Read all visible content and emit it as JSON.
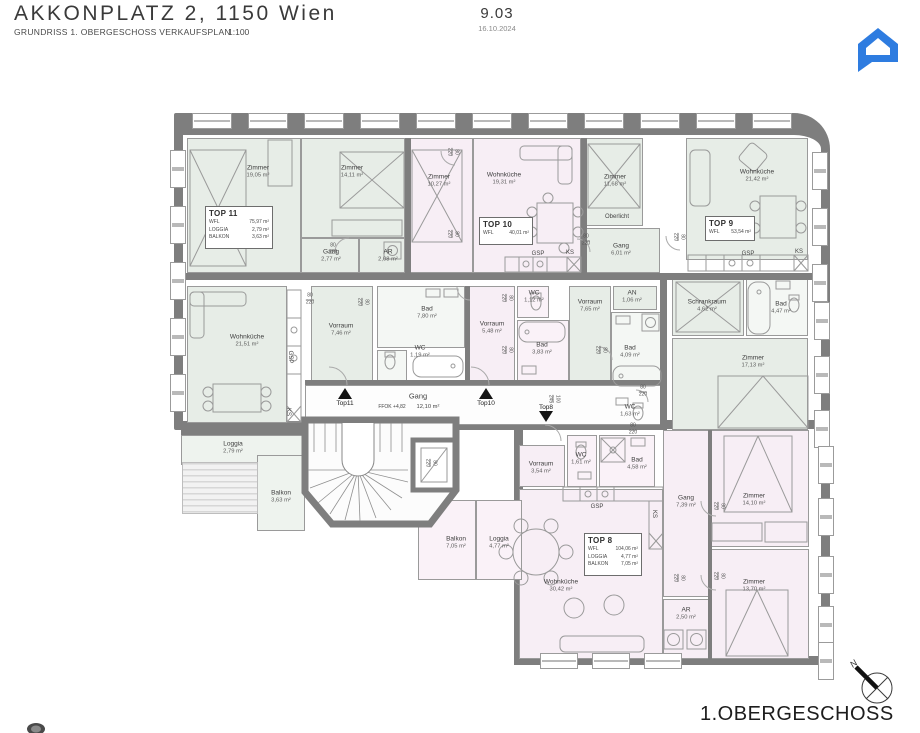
{
  "header": {
    "title": "AKKONPLATZ 2, 1150 Wien",
    "subtitle": "GRUNDRISS 1. OBERGESCHOSS VERKAUFSPLAN",
    "scale": "1:100",
    "plan_number": "9.03",
    "date": "16.10.2024"
  },
  "footer": {
    "floor_label": "1.OBERGESCHOSS",
    "north_label": "N"
  },
  "colors": {
    "accent_blue": "#2e7ce0",
    "wall_gray": "#7e7e7e",
    "mint": "#e7ede7",
    "pink": "#f7eef5",
    "mint_light": "#eef3ee",
    "pink_light": "#faf2f8",
    "white": "#fdfdfd",
    "white_tint": "#f4f7f4"
  },
  "tops": [
    {
      "id": "TOP 11",
      "x": 205,
      "y": 206,
      "w": 68,
      "h": 43,
      "rows": [
        [
          "WFL",
          "75,97 m²"
        ],
        [
          "LOGGIA",
          "2,79 m²"
        ],
        [
          "BALKON",
          "3,63 m²"
        ]
      ]
    },
    {
      "id": "TOP 10",
      "x": 479,
      "y": 217,
      "w": 54,
      "h": 28,
      "rows": [
        [
          "WFL",
          "40,01 m²"
        ]
      ]
    },
    {
      "id": "TOP 9",
      "x": 705,
      "y": 216,
      "w": 50,
      "h": 25,
      "rows": [
        [
          "WFL",
          "53,54 m²"
        ]
      ]
    },
    {
      "id": "TOP 8",
      "x": 584,
      "y": 533,
      "w": 58,
      "h": 43,
      "rows": [
        [
          "WFL",
          "104,06 m²"
        ],
        [
          "LOGGIA",
          "4,77 m²"
        ],
        [
          "BALKON",
          "7,05 m²"
        ]
      ]
    }
  ],
  "rooms": [
    {
      "n": "Zimmer",
      "a": "19,05 m²",
      "x": 187,
      "y": 138,
      "w": 114,
      "h": 135,
      "f": "m",
      "lx": 258,
      "ly": 172
    },
    {
      "n": "Zimmer",
      "a": "14,11 m²",
      "x": 301,
      "y": 138,
      "w": 104,
      "h": 100,
      "f": "m",
      "lx": 352,
      "ly": 172
    },
    {
      "n": "Gang",
      "a": "2,77 m²",
      "x": 301,
      "y": 238,
      "w": 58,
      "h": 35,
      "f": "m",
      "lx": 331,
      "ly": 256
    },
    {
      "n": "AR",
      "a": "2,08 m²",
      "x": 359,
      "y": 238,
      "w": 46,
      "h": 35,
      "f": "m",
      "lx": 388,
      "ly": 256
    },
    {
      "n": "Zimmer",
      "a": "10,27 m²",
      "x": 409,
      "y": 138,
      "w": 64,
      "h": 135,
      "f": "p",
      "lx": 439,
      "ly": 181
    },
    {
      "n": "Wohnküche",
      "a": "19,31 m²",
      "x": 473,
      "y": 138,
      "w": 108,
      "h": 135,
      "f": "p",
      "lx": 504,
      "ly": 179
    },
    {
      "n": "Zimmer",
      "a": "11,68 m²",
      "x": 585,
      "y": 138,
      "w": 58,
      "h": 88,
      "f": "m",
      "lx": 615,
      "ly": 181
    },
    {
      "n": "Gang",
      "a": "6,01 m²",
      "x": 585,
      "y": 228,
      "w": 75,
      "h": 45,
      "f": "m",
      "lx": 621,
      "ly": 250
    },
    {
      "n": "Wohnküche",
      "a": "21,42 m²",
      "x": 686,
      "y": 138,
      "w": 122,
      "h": 122,
      "f": "m",
      "lx": 757,
      "ly": 176
    },
    {
      "n": "Wohnküche",
      "a": "21,51 m²",
      "x": 187,
      "y": 286,
      "w": 100,
      "h": 137,
      "f": "m",
      "lx": 247,
      "ly": 341
    },
    {
      "n": "Vorraum",
      "a": "7,46 m²",
      "x": 311,
      "y": 286,
      "w": 62,
      "h": 97,
      "f": "m",
      "lx": 341,
      "ly": 330
    },
    {
      "n": "Bad",
      "a": "7,80 m²",
      "x": 377,
      "y": 286,
      "w": 88,
      "h": 62,
      "f": "wt",
      "lx": 427,
      "ly": 313
    },
    {
      "n": "WC",
      "a": "1,19 m²",
      "x": 377,
      "y": 350,
      "w": 30,
      "h": 33,
      "f": "wt",
      "lx": 420,
      "ly": 352
    },
    {
      "n": "Vorraum",
      "a": "5,48 m²",
      "x": 467,
      "y": 286,
      "w": 48,
      "h": 97,
      "f": "p",
      "lx": 492,
      "ly": 328
    },
    {
      "n": "WC",
      "a": "1,12 m²",
      "x": 517,
      "y": 286,
      "w": 32,
      "h": 32,
      "f": "pl",
      "lx": 534,
      "ly": 297
    },
    {
      "n": "Bad",
      "a": "3,83 m²",
      "x": 517,
      "y": 320,
      "w": 52,
      "h": 63,
      "f": "pl",
      "lx": 542,
      "ly": 349
    },
    {
      "n": "Vorraum",
      "a": "7,65 m²",
      "x": 569,
      "y": 286,
      "w": 42,
      "h": 97,
      "f": "m",
      "lx": 590,
      "ly": 306
    },
    {
      "n": "AN",
      "a": "1,06 m²",
      "x": 613,
      "y": 286,
      "w": 44,
      "h": 24,
      "f": "m",
      "lx": 632,
      "ly": 297
    },
    {
      "n": "Bad",
      "a": "4,09 m²",
      "x": 611,
      "y": 312,
      "w": 54,
      "h": 80,
      "f": "wt",
      "lx": 630,
      "ly": 352
    },
    {
      "n": "WC",
      "a": "1,63 m²",
      "x": 611,
      "y": 394,
      "w": 44,
      "h": 34,
      "f": "wt",
      "lx": 630,
      "ly": 411
    },
    {
      "n": "Schrankraum",
      "a": "4,62 m²",
      "x": 672,
      "y": 278,
      "w": 72,
      "h": 58,
      "f": "m",
      "lx": 707,
      "ly": 306
    },
    {
      "n": "Bad",
      "a": "4,47 m²",
      "x": 746,
      "y": 278,
      "w": 62,
      "h": 58,
      "f": "wt",
      "lx": 781,
      "ly": 308
    },
    {
      "n": "Zimmer",
      "a": "17,13 m²",
      "x": 672,
      "y": 338,
      "w": 136,
      "h": 92,
      "f": "m",
      "lx": 753,
      "ly": 362
    },
    {
      "n": "",
      "a": "",
      "x": 305,
      "y": 385,
      "w": 356,
      "h": 40,
      "f": "w",
      "lx": 0,
      "ly": 0
    },
    {
      "n": "Vorraum",
      "a": "3,54 m²",
      "x": 519,
      "y": 445,
      "w": 46,
      "h": 42,
      "f": "p",
      "lx": 541,
      "ly": 468
    },
    {
      "n": "WC",
      "a": "1,61 m²",
      "x": 567,
      "y": 435,
      "w": 30,
      "h": 52,
      "f": "pl",
      "lx": 581,
      "ly": 459
    },
    {
      "n": "Bad",
      "a": "4,58 m²",
      "x": 599,
      "y": 435,
      "w": 56,
      "h": 52,
      "f": "pl",
      "lx": 637,
      "ly": 464
    },
    {
      "n": "Gang",
      "a": "7,39 m²",
      "x": 663,
      "y": 430,
      "w": 46,
      "h": 167,
      "f": "p",
      "lx": 686,
      "ly": 502
    },
    {
      "n": "Wohnküche",
      "a": "30,42 m²",
      "x": 519,
      "y": 489,
      "w": 144,
      "h": 170,
      "f": "p",
      "lx": 561,
      "ly": 586
    },
    {
      "n": "Zimmer",
      "a": "14,10 m²",
      "x": 711,
      "y": 430,
      "w": 98,
      "h": 117,
      "f": "p",
      "lx": 754,
      "ly": 500
    },
    {
      "n": "Zimmer",
      "a": "13,70 m²",
      "x": 711,
      "y": 549,
      "w": 98,
      "h": 110,
      "f": "p",
      "lx": 754,
      "ly": 586
    },
    {
      "n": "AR",
      "a": "2,50 m²",
      "x": 663,
      "y": 599,
      "w": 46,
      "h": 60,
      "f": "p",
      "lx": 686,
      "ly": 614
    },
    {
      "n": "Loggia",
      "a": "2,79 m²",
      "x": 181,
      "y": 435,
      "w": 122,
      "h": 30,
      "f": "ml",
      "lx": 233,
      "ly": 448
    },
    {
      "n": "Balkon",
      "a": "3,63 m²",
      "x": 257,
      "y": 455,
      "w": 48,
      "h": 76,
      "f": "ml",
      "lx": 281,
      "ly": 497
    },
    {
      "n": "Balkon",
      "a": "7,05 m²",
      "x": 418,
      "y": 500,
      "w": 58,
      "h": 80,
      "f": "pl",
      "lx": 456,
      "ly": 543
    },
    {
      "n": "Loggia",
      "a": "4,77 m²",
      "x": 476,
      "y": 500,
      "w": 46,
      "h": 80,
      "f": "pl",
      "lx": 499,
      "ly": 543
    }
  ],
  "labels": [
    {
      "t": "Oberlicht",
      "x": 617,
      "y": 217,
      "s": 6
    },
    {
      "t": "GSP",
      "x": 538,
      "y": 254,
      "s": 6
    },
    {
      "t": "KS",
      "x": 570,
      "y": 253,
      "s": 6
    },
    {
      "t": "GSP",
      "x": 748,
      "y": 254,
      "s": 6
    },
    {
      "t": "KS",
      "x": 799,
      "y": 252,
      "s": 6
    },
    {
      "t": "GSP",
      "x": 290,
      "y": 357,
      "s": 6,
      "r": 90
    },
    {
      "t": "KS",
      "x": 288,
      "y": 412,
      "s": 6,
      "r": 90
    },
    {
      "t": "GSP",
      "x": 597,
      "y": 507,
      "s": 6
    },
    {
      "t": "KS",
      "x": 654,
      "y": 514,
      "s": 6,
      "r": 90
    },
    {
      "t": "Gang",
      "x": 418,
      "y": 396,
      "s": 7.5
    },
    {
      "t": "FFOK +4,82",
      "x": 392,
      "y": 407,
      "s": 5
    },
    {
      "t": "12,10 m²",
      "x": 428,
      "y": 407,
      "s": 5.8
    }
  ],
  "door_labels": [
    {
      "x": 333,
      "y": 250
    },
    {
      "x": 452,
      "y": 152,
      "v": 1
    },
    {
      "x": 452,
      "y": 234,
      "v": 1
    },
    {
      "x": 310,
      "y": 300
    },
    {
      "x": 362,
      "y": 302,
      "v": 1
    },
    {
      "x": 586,
      "y": 241
    },
    {
      "x": 678,
      "y": 237,
      "v": 1
    },
    {
      "x": 506,
      "y": 298,
      "v": 1
    },
    {
      "x": 506,
      "y": 350,
      "v": 1
    },
    {
      "x": 600,
      "y": 350,
      "v": 1
    },
    {
      "x": 643,
      "y": 392
    },
    {
      "x": 718,
      "y": 506,
      "v": 1
    },
    {
      "x": 718,
      "y": 576,
      "v": 1
    },
    {
      "x": 678,
      "y": 578,
      "v": 1
    },
    {
      "x": 633,
      "y": 430
    },
    {
      "t1": "100",
      "t2": "245",
      "x": 553,
      "y": 399,
      "v": 1
    },
    {
      "x": 430,
      "y": 463,
      "v": 1
    }
  ],
  "door_label_default": {
    "t1": "80",
    "t2": "220"
  },
  "markers": [
    {
      "t": "Top11",
      "x": 345,
      "y": 388,
      "d": "up"
    },
    {
      "t": "Top10",
      "x": 486,
      "y": 388,
      "d": "up"
    },
    {
      "t": "Top8",
      "x": 546,
      "y": 403,
      "d": "down"
    }
  ],
  "windows": {
    "top": [
      192,
      248,
      304,
      360,
      416,
      472,
      528,
      584,
      640,
      696,
      752
    ],
    "left": [
      150,
      206,
      262,
      318,
      374
    ],
    "right": [
      {
        "x": 812,
        "y": 152
      },
      {
        "x": 812,
        "y": 208
      },
      {
        "x": 812,
        "y": 264
      },
      {
        "x": 814,
        "y": 302
      },
      {
        "x": 814,
        "y": 356
      },
      {
        "x": 814,
        "y": 410
      },
      {
        "x": 818,
        "y": 446
      },
      {
        "x": 818,
        "y": 498
      },
      {
        "x": 818,
        "y": 556
      },
      {
        "x": 818,
        "y": 606
      },
      {
        "x": 818,
        "y": 642
      }
    ],
    "bottom": [
      540,
      592,
      644
    ]
  }
}
